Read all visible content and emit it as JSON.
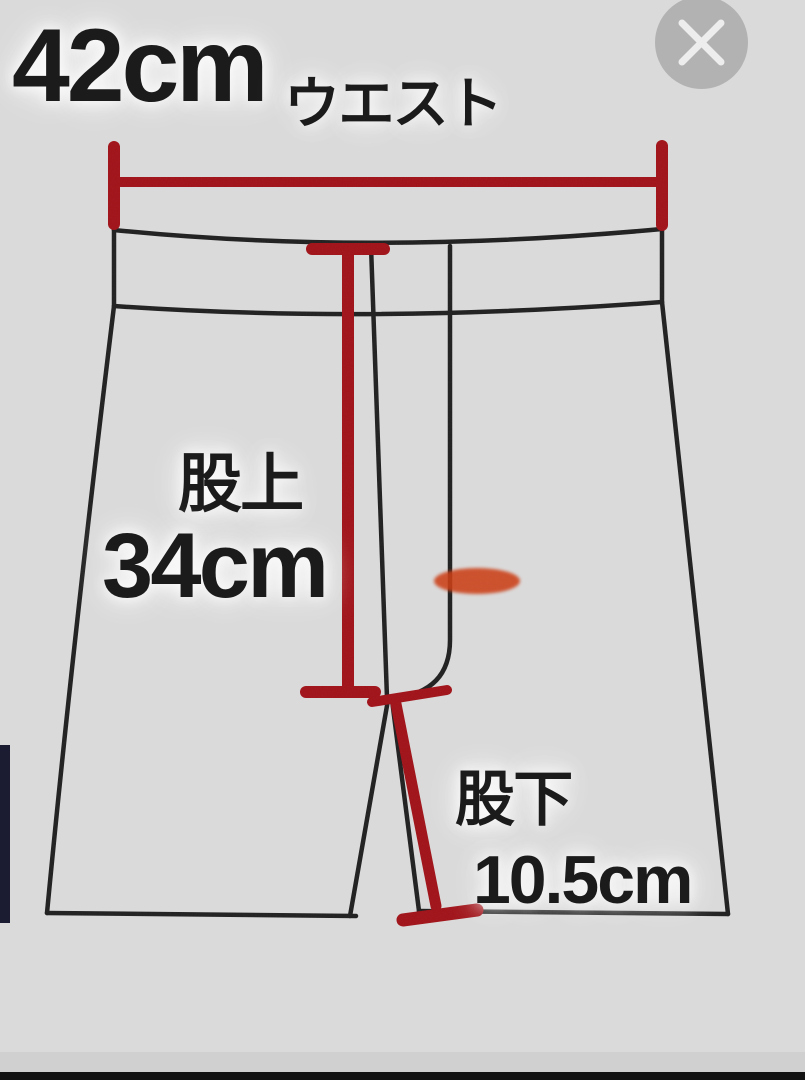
{
  "title": "shorts-size-diagram",
  "measurements": {
    "waist": {
      "label": "ウエスト",
      "value": "42cm"
    },
    "rise": {
      "label": "股上",
      "value": "34cm"
    },
    "inseam": {
      "label": "股下",
      "value": "10.5cm"
    }
  },
  "close_button": {
    "icon": "close-x"
  },
  "colors": {
    "background": "#dbdbdb",
    "outline": "#1f1f1f",
    "measure_red": "#a01117",
    "highlight_orange": "#cc3c12",
    "close_circle": "#b2b2b2",
    "close_x": "#ededed",
    "left_bar_navy": "#1b1b32",
    "bottom_bar_black": "#121212"
  }
}
